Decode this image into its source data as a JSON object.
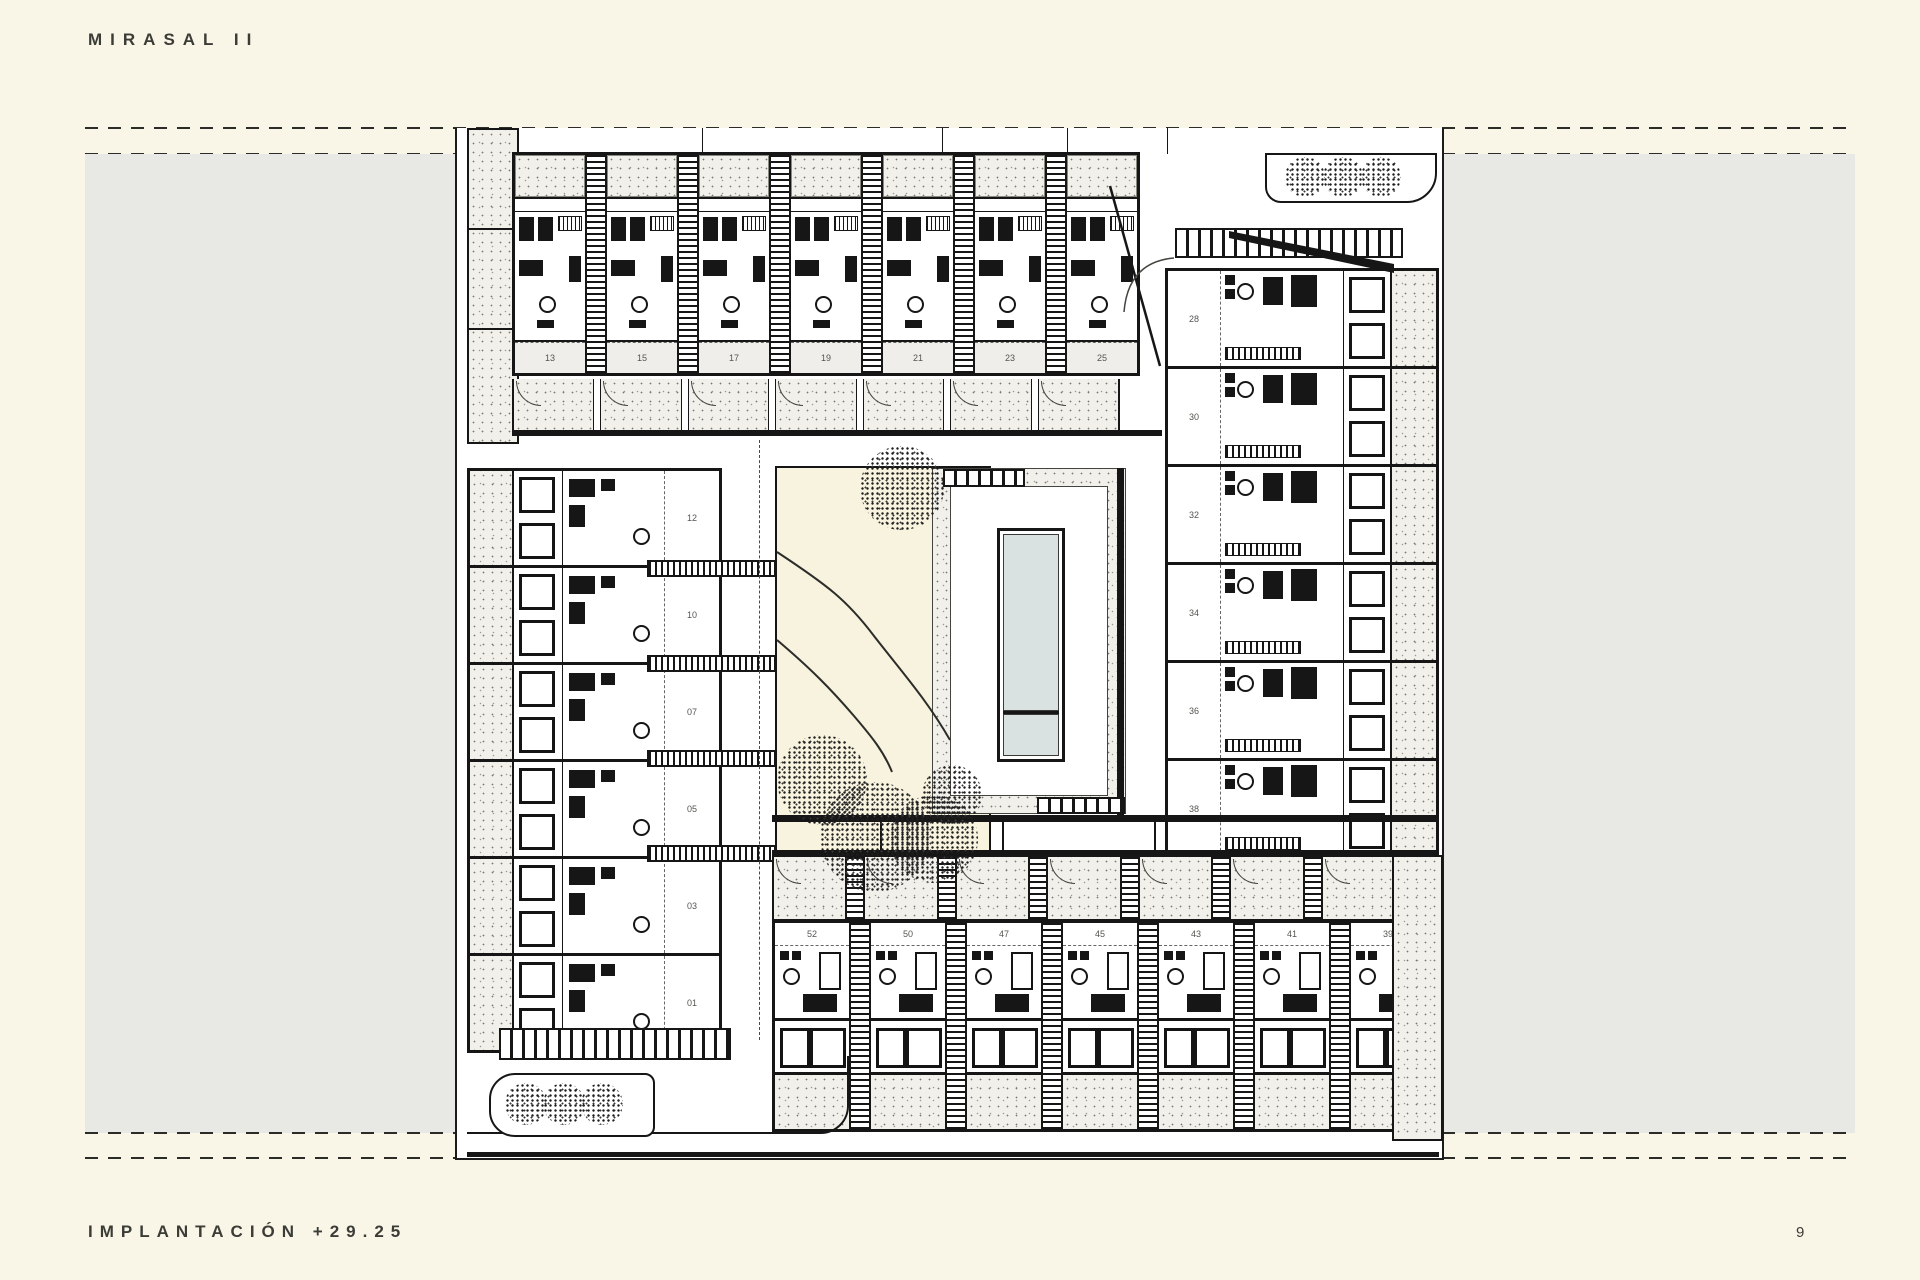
{
  "page": {
    "title": "MIRASAL II",
    "footer_label": "IMPLANTACIÓN +29.25",
    "page_number": "9"
  },
  "plan": {
    "unit_numbers": {
      "top_row": [
        "13",
        "15",
        "17",
        "19",
        "21",
        "23",
        "25"
      ],
      "right_column": [
        "28",
        "30",
        "32",
        "34",
        "36",
        "38"
      ],
      "left_column": [
        "12",
        "10",
        "07",
        "05",
        "03",
        "01"
      ],
      "bottom_row": [
        "52",
        "50",
        "47",
        "45",
        "43",
        "41",
        "39"
      ]
    },
    "features": [
      "swimming-pool",
      "courtyard-garden",
      "tree-planters",
      "pedestrian-crosswalks",
      "stair-shafts"
    ],
    "colors": {
      "paper": "#f9f6e7",
      "drawing_margin": "#e8e8e5",
      "plan_white": "#ffffff",
      "stipple": "#f1f0ea",
      "garden": "#f7f3de",
      "pool_water": "#d9e2e0",
      "ink": "#161616"
    }
  }
}
